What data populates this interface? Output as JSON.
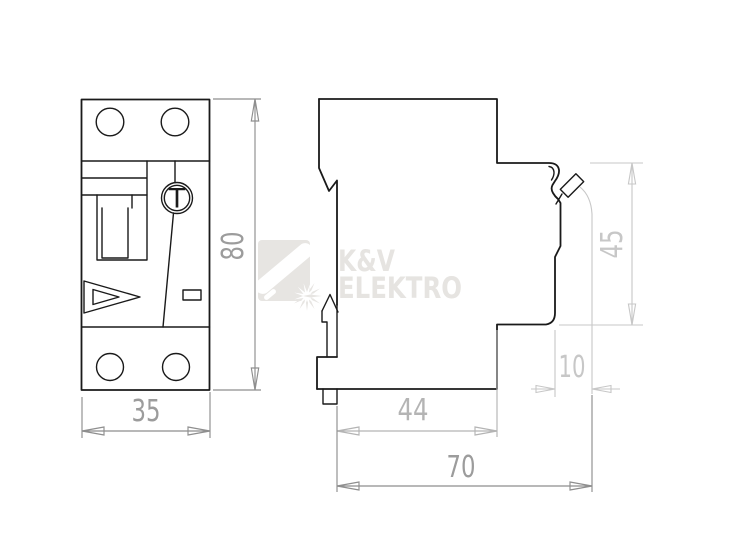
{
  "front_view": {
    "test_button_label": "T",
    "width_label": "35",
    "height_label": "80"
  },
  "side_view": {
    "upper_depth_label": "44",
    "total_depth_label": "70",
    "din_offset_label": "10",
    "front_section_height_label": "45"
  },
  "watermark": {
    "brand_line1": "K&V",
    "brand_line2": "ELEKTRO"
  },
  "colors": {
    "drawing_line": "#1a1a1a",
    "dimension_primary": "#8e8e8e",
    "dimension_secondary": "#b4b4b4",
    "dimension_light": "#c7c7c7",
    "watermark_gray": "#e6e4e1"
  }
}
